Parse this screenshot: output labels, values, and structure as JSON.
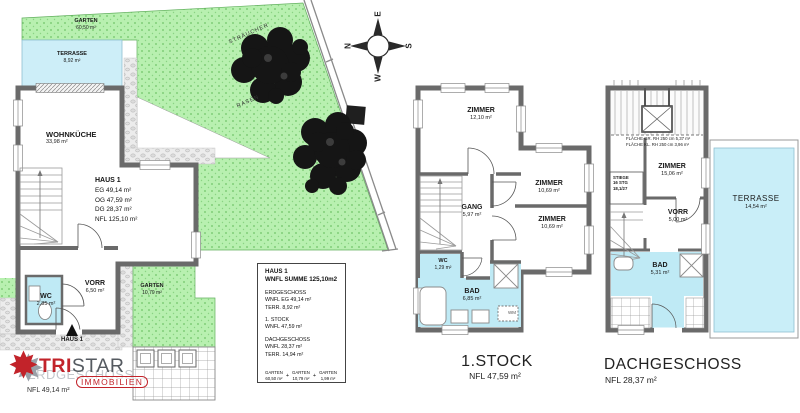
{
  "site": {
    "garten": {
      "name": "GARTEN",
      "area": "60,50 m²"
    },
    "terrasse": {
      "name": "TERRASSE",
      "area": "8,92 m²"
    },
    "straeucher": "STRÄUCHER",
    "rasen": "RASEN",
    "compass": {
      "n": "N",
      "e": "E",
      "s": "S",
      "w": "W"
    }
  },
  "eg": {
    "haus_info": {
      "title": "HAUS 1",
      "line1": "EG 49,14 m²",
      "line2": "OG 47,59 m²",
      "line3": "DG 28,37 m²",
      "line4": "NFL 125,10 m²"
    },
    "wohnkueche": {
      "name": "WOHNKÜCHE",
      "area": "33,98 m²"
    },
    "vorr": {
      "name": "VORR",
      "area": "6,50 m²"
    },
    "wc": {
      "name": "WC",
      "area": "2,85 m²"
    },
    "garten_patch": {
      "name": "GARTEN",
      "area": "10,79 m²"
    },
    "entrance": "HAUS 1",
    "title": "ERDGESCHOSS",
    "nfl": "NFL 49,14 m²"
  },
  "logo": {
    "tri": "TRI",
    "star": "STAR",
    "sub": "IMMOBILIEN",
    "star_glyph": "✸"
  },
  "infobox": {
    "title": "HAUS 1",
    "subtitle": "WNFL SUMME 125,10m2",
    "eg_h": "ERDGESCHOSS",
    "eg_1": "WNFL EG 49,14 m²",
    "eg_2": "TERR. 8,92 m²",
    "og_h": "1. STOCK",
    "og_1": "WNFL 47,59 m²",
    "dg_h": "DACHGESCHOSS",
    "dg_1": "WNFL 28,37 m²",
    "dg_2": "TERR. 14,94 m²",
    "g1n": "GARTEN",
    "g1v": "60,50 m²",
    "plus1": "+",
    "g2n": "GARTEN",
    "g2v": "10,79 m²",
    "plus2": "+",
    "g3n": "GARTEN",
    "g3v": "1,99 m²"
  },
  "stock1": {
    "zimmer1": {
      "name": "ZIMMER",
      "area": "12,10 m²"
    },
    "zimmer2": {
      "name": "ZIMMER",
      "area": "10,69 m²"
    },
    "zimmer3": {
      "name": "ZIMMER",
      "area": "10,69 m²"
    },
    "gang": {
      "name": "GANG",
      "area": "5,97 m²"
    },
    "wc": {
      "name": "WC",
      "area": "1,29 m²"
    },
    "bad": {
      "name": "BAD",
      "area": "6,85 m²"
    },
    "wm": "WM",
    "title": "1.STOCK",
    "nfl": "NFL 47,59 m²"
  },
  "dg": {
    "zimmer": {
      "name": "ZIMMER",
      "area": "15,06 m²"
    },
    "vorr": {
      "name": "VORR",
      "area": "5,00 m²"
    },
    "bad": {
      "name": "BAD",
      "area": "5,31 m²"
    },
    "terrasse": {
      "name": "TERRASSE",
      "area": "14,54 m²"
    },
    "flaeche1": "FLÄCHE GR. RH 250 cm 5,37 m²",
    "flaeche2": "FLÄCHE KL. RH 250 cm 3,96 m²",
    "stiege1": "STIEGE",
    "stiege2": "16 STG",
    "stiege3": "18,1/27",
    "title": "DACHGESCHOSS",
    "nfl": "NFL 28,37 m²"
  }
}
